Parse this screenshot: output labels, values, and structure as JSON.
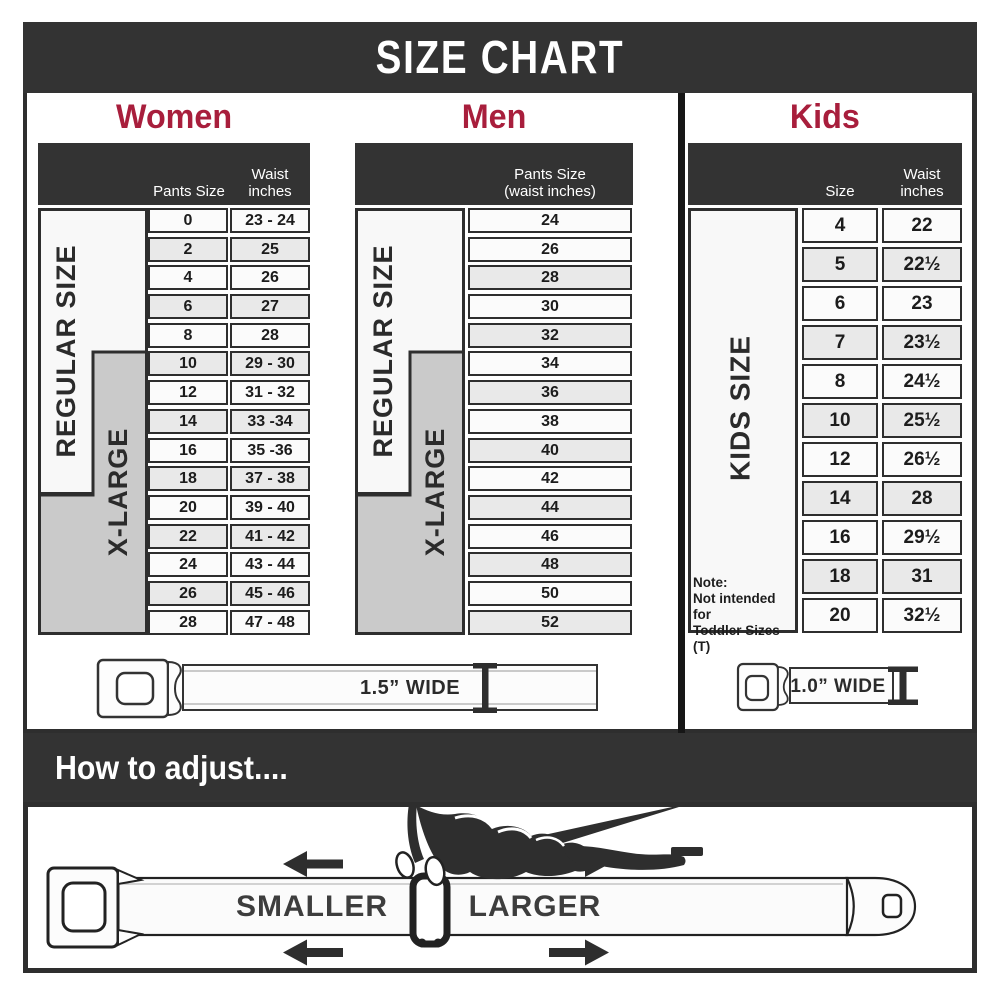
{
  "title": "SIZE CHART",
  "colors": {
    "band_dark": "#333333",
    "accent_red": "#A81E3C",
    "row_white": "#fbfbfb",
    "row_gray": "#e9e9e9",
    "side_gray": "#cacaca",
    "line_dark": "#2e2e2e"
  },
  "women": {
    "heading": "Women",
    "col1_header": "Pants Size",
    "col2_header_line1": "Waist",
    "col2_header_line2": "inches",
    "regular_label": "REGULAR SIZE",
    "xlarge_label": "X-LARGE",
    "rows": [
      [
        "0",
        "23 - 24"
      ],
      [
        "2",
        "25"
      ],
      [
        "4",
        "26"
      ],
      [
        "6",
        "27"
      ],
      [
        "8",
        "28"
      ],
      [
        "10",
        "29 - 30"
      ],
      [
        "12",
        "31 - 32"
      ],
      [
        "14",
        "33 -34"
      ],
      [
        "16",
        "35 -36"
      ],
      [
        "18",
        "37 - 38"
      ],
      [
        "20",
        "39 - 40"
      ],
      [
        "22",
        "41 - 42"
      ],
      [
        "24",
        "43 - 44"
      ],
      [
        "26",
        "45 - 46"
      ],
      [
        "28",
        "47 - 48"
      ]
    ]
  },
  "men": {
    "heading": "Men",
    "col_header_line1": "Pants Size",
    "col_header_line2": "(waist inches)",
    "regular_label": "REGULAR SIZE",
    "xlarge_label": "X-LARGE",
    "rows": [
      "24",
      "26",
      "28",
      "30",
      "32",
      "34",
      "36",
      "38",
      "40",
      "42",
      "44",
      "46",
      "48",
      "50",
      "52"
    ]
  },
  "kids": {
    "heading": "Kids",
    "col1_header": "Size",
    "col2_header_line1": "Waist",
    "col2_header_line2": "inches",
    "side_label": "KIDS SIZE",
    "note": [
      "Note:",
      "Not intended for",
      "Toddler Sizes (T)"
    ],
    "rows": [
      [
        "4",
        "22"
      ],
      [
        "5",
        "22½"
      ],
      [
        "6",
        "23"
      ],
      [
        "7",
        "23½"
      ],
      [
        "8",
        "24½"
      ],
      [
        "10",
        "25½"
      ],
      [
        "12",
        "26½"
      ],
      [
        "14",
        "28"
      ],
      [
        "16",
        "29½"
      ],
      [
        "18",
        "31"
      ],
      [
        "20",
        "32½"
      ]
    ]
  },
  "belts": {
    "adult": {
      "label": "1.5” WIDE"
    },
    "kids": {
      "label": "1.0” WIDE"
    }
  },
  "adjust": {
    "heading": "How to adjust....",
    "smaller": "SMALLER",
    "larger": "LARGER"
  }
}
